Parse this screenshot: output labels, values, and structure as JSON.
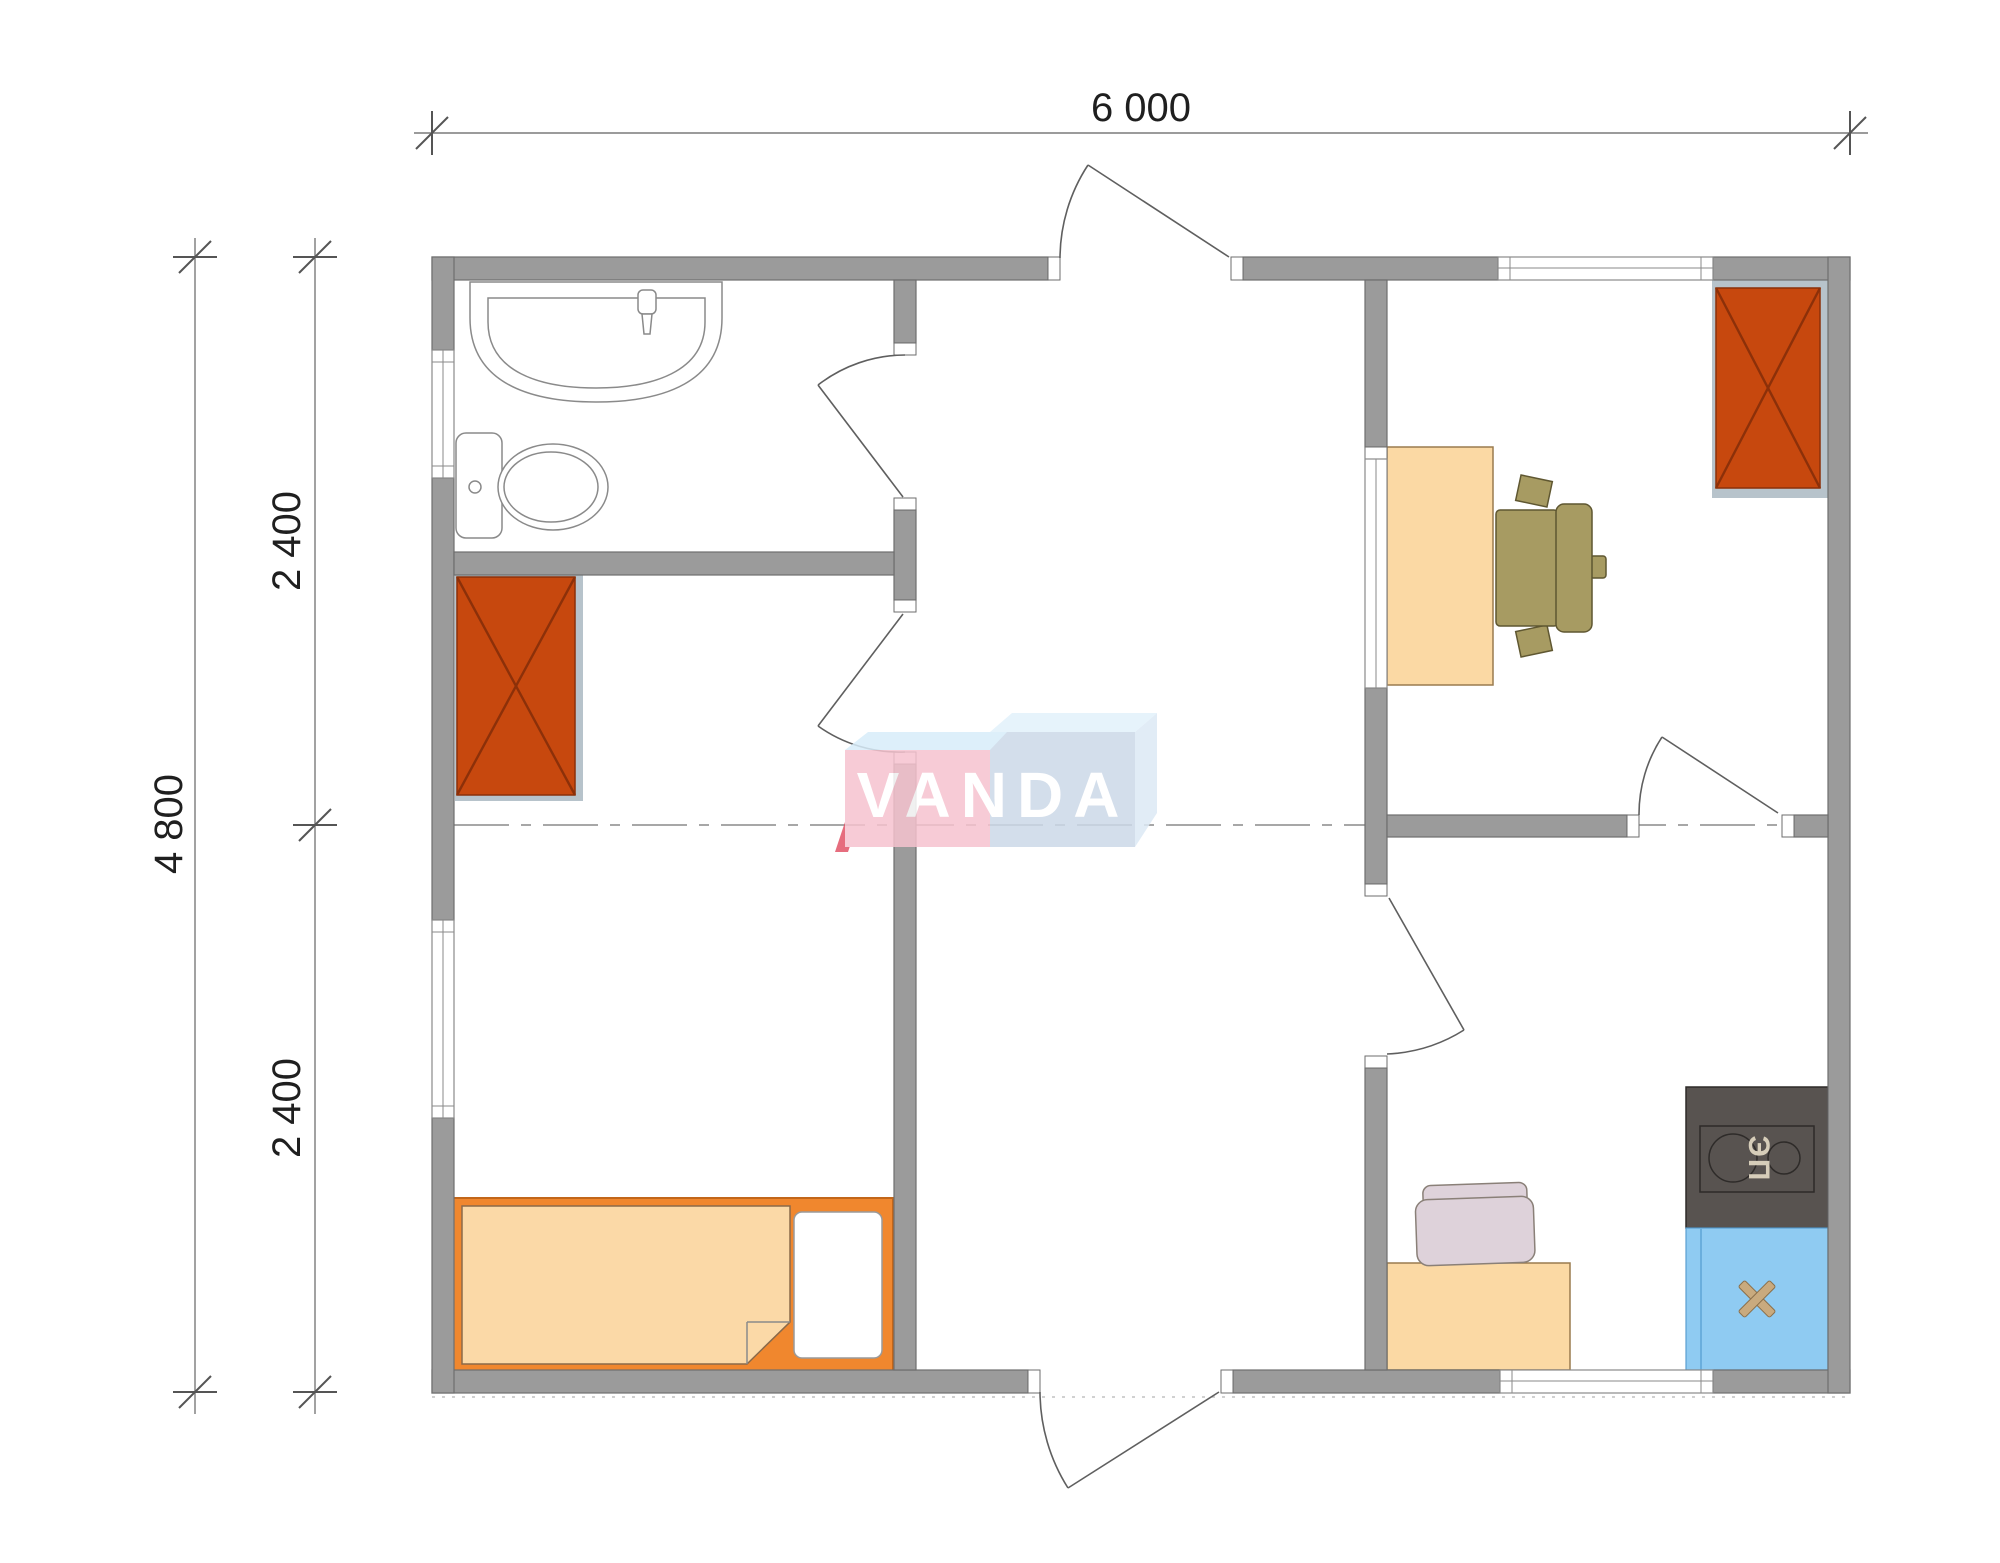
{
  "watermark": {
    "text": "VANDA"
  },
  "dimensions": {
    "top_total": "6 000",
    "left_total": "4 800",
    "left_upper": "2 400",
    "left_lower": "2 400"
  },
  "stove_label": "ЭП",
  "furniture_symbols": [
    {
      "name": "washbasin"
    },
    {
      "name": "toilet"
    },
    {
      "name": "wardrobe-left"
    },
    {
      "name": "bed-with-mattress-and-pillow"
    },
    {
      "name": "desk"
    },
    {
      "name": "office-chair"
    },
    {
      "name": "wardrobe-right"
    },
    {
      "name": "electric-stove"
    },
    {
      "name": "kitchen-sink"
    },
    {
      "name": "kitchen-counter"
    },
    {
      "name": "kitchen-chair"
    }
  ],
  "colors": {
    "wall": "#9b9b9b",
    "wallStroke": "#6e6e6e",
    "lineGray": "#8a8a8a",
    "doorStroke": "#5f5f5f",
    "fixtureStroke": "#8a8a8a",
    "dimLine": "#7a7a7a",
    "dimTick": "#555555",
    "dimText": "#1f1f1f",
    "dashLine": "#8a8a8a",
    "pad": "#b7c3cb",
    "bedPad": "#7e98ac",
    "wardrobe": "#c7480e",
    "wardrobeStroke": "#8c3009",
    "peach": "#fbd9a4",
    "peachStroke": "#9a7b4f",
    "olive": "#a79b62",
    "oliveStroke": "#5f5731",
    "stove": "#585350",
    "stoveLine": "#2e2b29",
    "stoveLabel": "#d6cdb9",
    "sinkBlue": "#8fcbf2",
    "sinkBlueStroke": "#5a9fd0",
    "crossTan": "#c9aa7e",
    "bedOrange": "#f0872e",
    "bedOrangeStroke": "#c2661a",
    "mattress": "#fbd9a7",
    "mattressStroke": "#8a6a4a",
    "chairPink": "#ded2da",
    "chairPinkStroke": "#8a8078",
    "logoPink": "#f6c3cf",
    "logoBlue": "#ccd9e8",
    "logoCyan": "#d8edfa",
    "logoCyanLight": "#e2f1fb",
    "logoSide": "#dce9f5",
    "logoRed": "#e25468",
    "logoText": "#ffffff"
  }
}
